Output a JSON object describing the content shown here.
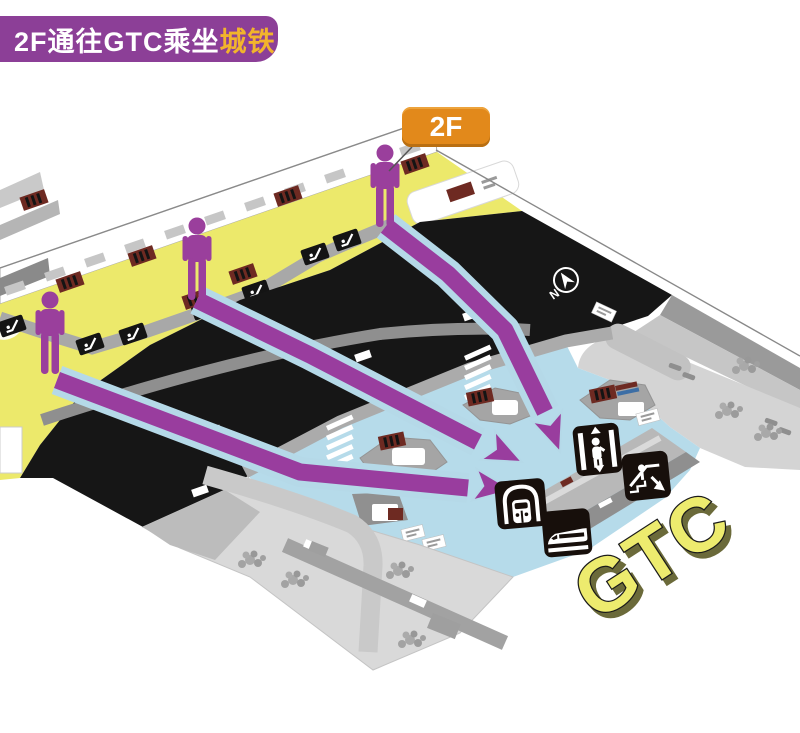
{
  "title_banner": {
    "text_main": "2F通往GTC乘坐",
    "text_highlight": "城铁"
  },
  "floor_badge": {
    "label": "2F"
  },
  "map": {
    "gtc_label": "GTC",
    "compass": {
      "label": "N"
    },
    "pedestrian_count": 3,
    "route_arrow_count": 3,
    "transit_icons": [
      "elevator",
      "escalator-down",
      "metro",
      "intercity-train"
    ],
    "small_markers": [
      "escalator-pad",
      "shelter-sign",
      "crosswalk",
      "tree-cluster"
    ]
  },
  "colors": {
    "banner_bg": "#8C3F97",
    "banner_text": "#FFFFFF",
    "banner_highlight": "#F2B42C",
    "badge_bg": "#E2891B",
    "person_purple": "#9A3F9C",
    "arrow_purple": "#993D9E",
    "arrow_halo": "#B5D9E8",
    "curb_yellow": "#ECE96B",
    "road_black": "#161616",
    "hall_blue": "#B6DBEA",
    "island_gray": "#A5A5A5",
    "ground_gray": "#D9D9D9",
    "sign_dark_red": "#6E2A22",
    "gtc_fill": "#EDEB6E",
    "gtc_outline": "#1A1A1A",
    "icon_bg": "#170F0B"
  }
}
